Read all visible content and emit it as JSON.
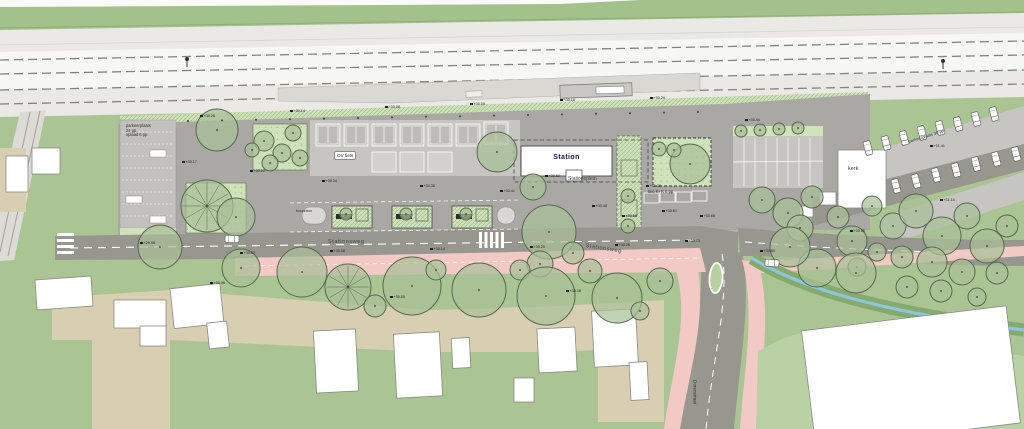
{
  "plan": {
    "title": "station area site plan",
    "labels": {
      "station": "Station",
      "stationsplein": "Stationsplein",
      "stationsweg_west": "Stationsweg",
      "stationsweg_east": "Stationsweg",
      "ov_fiets": "OV fiets",
      "kerk": "kerk",
      "taxi": "taxi K+R 6 pp",
      "busperron": "busperron",
      "parking_left_line1": "parkeerplaats",
      "parking_left_line2": "24 pp",
      "parking_left_line3": "oplaad 6 pp",
      "parking_right": "parkeerplaats 30 pp",
      "street_south": "Dorenstraat"
    },
    "colors": {
      "green_field": "#abc493",
      "green_top": "#a3c18b",
      "green_light": "#cfe2ba",
      "green_bright": "#b9d1a4",
      "bank_green": "#86aa6c",
      "water_blue": "#8ec6df",
      "rail_gray": "#eae9e5",
      "rail_white": "#f7f7f4",
      "platform_gray": "#d9d8d3",
      "plaza_gray": "#a9a8a4",
      "road_gray": "#98978f",
      "parking_gray": "#c6c5c1",
      "strip_gray": "#c2c1bd",
      "pink_path": "#f2c9c5",
      "beige": "#d8cfb3",
      "building_white": "#ffffff",
      "outline_gray": "#8a8a86",
      "tree_fill": "#a9bf97",
      "tree_stroke": "#55684e",
      "track_dash": "#84837f"
    },
    "trees": [
      [
        217,
        130,
        21,
        0
      ],
      [
        264,
        141,
        10,
        0
      ],
      [
        282,
        153,
        9,
        0
      ],
      [
        270,
        163,
        8,
        0
      ],
      [
        293,
        133,
        8,
        0
      ],
      [
        300,
        158,
        8,
        0
      ],
      [
        252,
        150,
        7,
        0
      ],
      [
        207,
        206,
        26,
        1
      ],
      [
        236,
        217,
        19,
        0
      ],
      [
        160,
        247,
        22,
        0
      ],
      [
        497,
        152,
        20,
        0
      ],
      [
        533,
        187,
        13,
        0
      ],
      [
        549,
        232,
        27,
        0
      ],
      [
        573,
        253,
        11,
        0
      ],
      [
        540,
        264,
        13,
        0
      ],
      [
        520,
        270,
        10,
        0
      ],
      [
        690,
        164,
        20,
        0
      ],
      [
        659,
        149,
        7,
        0
      ],
      [
        674,
        150,
        7,
        0
      ],
      [
        628,
        196,
        7,
        0
      ],
      [
        628,
        226,
        7,
        0
      ],
      [
        741,
        131,
        6,
        0
      ],
      [
        760,
        130,
        6,
        0
      ],
      [
        779,
        129,
        6,
        0
      ],
      [
        798,
        128,
        6,
        0
      ],
      [
        762,
        200,
        13,
        0
      ],
      [
        788,
        213,
        15,
        0
      ],
      [
        812,
        197,
        11,
        0
      ],
      [
        800,
        228,
        13,
        0
      ],
      [
        838,
        217,
        11,
        0
      ],
      [
        852,
        241,
        15,
        0
      ],
      [
        872,
        206,
        10,
        0
      ],
      [
        893,
        226,
        13,
        0
      ],
      [
        916,
        211,
        17,
        0
      ],
      [
        942,
        236,
        19,
        0
      ],
      [
        967,
        216,
        13,
        0
      ],
      [
        987,
        246,
        17,
        0
      ],
      [
        1007,
        226,
        11,
        0
      ],
      [
        932,
        262,
        15,
        0
      ],
      [
        902,
        257,
        11,
        0
      ],
      [
        962,
        272,
        13,
        0
      ],
      [
        997,
        273,
        11,
        0
      ],
      [
        877,
        252,
        9,
        0
      ],
      [
        857,
        267,
        9,
        0
      ],
      [
        907,
        287,
        11,
        0
      ],
      [
        941,
        291,
        11,
        0
      ],
      [
        977,
        297,
        9,
        0
      ],
      [
        817,
        268,
        19,
        0
      ],
      [
        856,
        273,
        20,
        0
      ],
      [
        790,
        247,
        20,
        0
      ],
      [
        302,
        272,
        25,
        0
      ],
      [
        348,
        287,
        23,
        1
      ],
      [
        241,
        268,
        19,
        0
      ],
      [
        412,
        286,
        29,
        0
      ],
      [
        479,
        290,
        27,
        0
      ],
      [
        546,
        296,
        29,
        0
      ],
      [
        617,
        298,
        25,
        0
      ],
      [
        660,
        281,
        13,
        0
      ],
      [
        375,
        306,
        11,
        0
      ],
      [
        590,
        271,
        12,
        0
      ],
      [
        640,
        311,
        9,
        0
      ],
      [
        436,
        270,
        10,
        0
      ],
      [
        346,
        214,
        6,
        0
      ],
      [
        406,
        214,
        6,
        0
      ],
      [
        466,
        214,
        6,
        0
      ]
    ],
    "cars": [
      [
        868,
        148,
        75
      ],
      [
        886,
        143,
        75
      ],
      [
        904,
        138,
        75
      ],
      [
        922,
        133,
        75
      ],
      [
        940,
        128,
        75
      ],
      [
        958,
        124,
        75
      ],
      [
        976,
        119,
        75
      ],
      [
        994,
        114,
        75
      ],
      [
        896,
        186,
        75
      ],
      [
        916,
        181,
        75
      ],
      [
        936,
        175,
        75
      ],
      [
        956,
        170,
        75
      ],
      [
        976,
        164,
        75
      ],
      [
        996,
        159,
        75
      ],
      [
        1016,
        154,
        75
      ],
      [
        772,
        263,
        4
      ],
      [
        232,
        239,
        2
      ]
    ],
    "elevations": [
      [
        200,
        114,
        "+30.26"
      ],
      [
        290,
        109,
        "+30.14"
      ],
      [
        385,
        105,
        "+30.08"
      ],
      [
        470,
        102,
        "+30.05"
      ],
      [
        560,
        98,
        "+30.18"
      ],
      [
        650,
        96,
        "+30.29"
      ],
      [
        745,
        118,
        "+30.44"
      ],
      [
        182,
        160,
        "+30.17"
      ],
      [
        250,
        169,
        "+30.22"
      ],
      [
        322,
        179,
        "+30.34"
      ],
      [
        420,
        184,
        "+30.38"
      ],
      [
        500,
        189,
        "+30.41"
      ],
      [
        545,
        174,
        "+30.52"
      ],
      [
        592,
        204,
        "+30.48"
      ],
      [
        622,
        214,
        "+30.56"
      ],
      [
        662,
        209,
        "+30.61"
      ],
      [
        700,
        214,
        "+30.68"
      ],
      [
        140,
        241,
        "+29.98"
      ],
      [
        240,
        251,
        "+30.02"
      ],
      [
        330,
        249,
        "+30.08"
      ],
      [
        430,
        247,
        "+30.14"
      ],
      [
        530,
        245,
        "+30.20"
      ],
      [
        615,
        243,
        "+30.26"
      ],
      [
        685,
        239,
        "+30.73"
      ],
      [
        210,
        281,
        "+30.38"
      ],
      [
        390,
        295,
        "+30.55"
      ],
      [
        566,
        289,
        "+30.48"
      ],
      [
        760,
        249,
        "+30.85"
      ],
      [
        850,
        229,
        "+30.95"
      ],
      [
        940,
        198,
        "+31.10"
      ],
      [
        930,
        144,
        "+31.41"
      ],
      [
        646,
        184,
        "+31.38"
      ]
    ]
  }
}
